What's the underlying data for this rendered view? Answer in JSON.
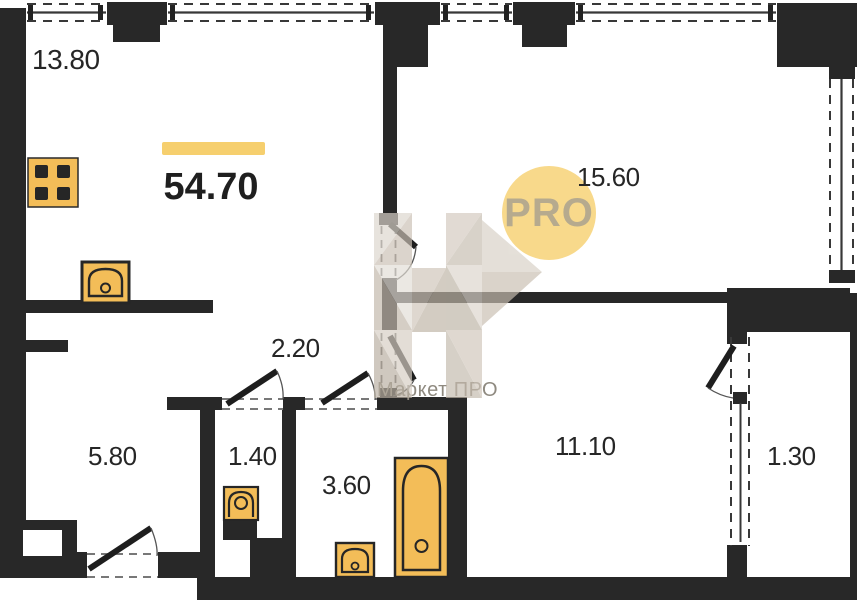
{
  "plan": {
    "total_area": "54.70",
    "rooms": [
      {
        "id": "kitchen-living",
        "area": "13.80"
      },
      {
        "id": "room-top-right",
        "area": "15.60"
      },
      {
        "id": "hallway",
        "area": "2.20"
      },
      {
        "id": "entry-hall",
        "area": "5.80"
      },
      {
        "id": "wc",
        "area": "1.40"
      },
      {
        "id": "bathroom",
        "area": "3.60"
      },
      {
        "id": "room-bottom-right",
        "area": "11.10"
      },
      {
        "id": "balcony",
        "area": "1.30"
      }
    ],
    "badge_text": "PRO",
    "watermark_text": "Маркет ПРО",
    "colors": {
      "wall": "#282828",
      "fixture_fill": "#f3bd58",
      "accent_bar": "#f6cf6e",
      "badge_fill": "#f8d98b",
      "badge_text": "#b6aa8e",
      "label_text": "#262626",
      "watermark_text": "#8f8a80"
    }
  }
}
